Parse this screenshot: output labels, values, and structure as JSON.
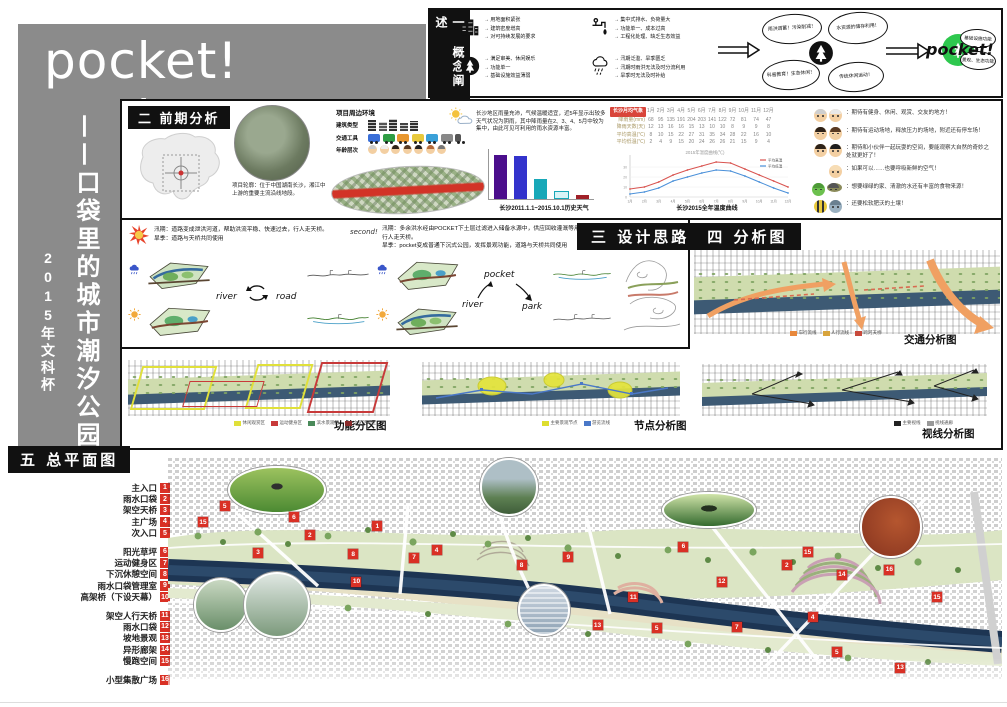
{
  "poster": {
    "title": "pocket! pocket!",
    "vertical_title": "——口袋里的城市潮汐公园",
    "vertical_sub": "2015年文科杯"
  },
  "concept": {
    "banner": "一 概念阐述",
    "groups": [
      {
        "icon": "city-buildings-icon",
        "bullets": [
          "用地面积紧张",
          "建筑密度增高",
          "对可持续发展的要求"
        ]
      },
      {
        "icon": "faucet-icon",
        "bullets": [
          "集中式排水、负荷量大",
          "功能单一、成本过高",
          "工程化处理、缺乏生态效益"
        ]
      },
      {
        "icon": "park-tree-icon",
        "bullets": [
          "满足审美、休闲娱乐",
          "功能单一",
          "基础设施效益薄弱"
        ]
      },
      {
        "icon": "rain-cloud-icon",
        "bullets": [
          "汛期泛滥、旱季匮乏",
          "汛期时雨洪无法及时分流利用",
          "旱季时无法及时补给"
        ]
      }
    ],
    "hub_bubbles": [
      "雨洪调蓄！污染削减！",
      "水资源的储存利用！",
      "科普教育！生态休闲！",
      "传统休闲运动！"
    ],
    "logo": "pocket!",
    "outcome_bubbles": [
      "基础设施功能",
      "景观、生态功能"
    ]
  },
  "analysis": {
    "banner": "二 前期分析",
    "location_text": "项目轮廓：位于中国湖南长沙，湘江中上游的重要主流沿线地段。",
    "env_title": "项目周边环境",
    "env_rows": [
      {
        "label": "建筑类型",
        "type": "building",
        "count": 5
      },
      {
        "label": "交通工具",
        "type": "vehicle",
        "count": 7
      },
      {
        "label": "年龄层次",
        "type": "face",
        "count": 7
      }
    ],
    "climate_text": "长沙地区雨量充沛，气候温暖适宜，近5年显示出较多天气状况为阴雨，其中降雨量在2、3、4、5月中较为集中，由此可见可利用的雨水资源丰富。",
    "voices": [
      {
        "who": [
          "elder-woman",
          "elder-man"
        ],
        "text": "期待有健身、休闲、观赏、交友的地方！"
      },
      {
        "who": [
          "man",
          "woman"
        ],
        "text": "期待有运动场地，释放压力的场地，附近还有停车场！"
      },
      {
        "who": [
          "man",
          "girl"
        ],
        "text": "期待和小伙伴一起玩耍的空间，要能观察大自然的奇妙之处就更好了！"
      },
      {
        "who": [
          "baby"
        ],
        "text": "如果可以……也要呼吸新鲜的空气！"
      },
      {
        "who": [
          "frog",
          "cricket"
        ],
        "text": "想要绿绿的家、清澈的水还有丰富的食物来源！"
      },
      {
        "who": [
          "bee",
          "bird"
        ],
        "text": "还要松软肥沃的土壤！"
      }
    ]
  },
  "chart_data": [
    {
      "type": "bar",
      "title": "长沙2011.1.1~2015.10.1历史天气",
      "categories": [
        "雨",
        "阴",
        "多云",
        "晴",
        "其他"
      ],
      "values": [
        620,
        600,
        280,
        90,
        60
      ],
      "colors": [
        "#4b0e8c",
        "#3333cc",
        "#18a8b8",
        "#18a8b8",
        "#a02028"
      ],
      "outline": [
        false,
        false,
        false,
        true,
        false
      ],
      "ylim": [
        0,
        700
      ],
      "ylabel": "天数"
    },
    {
      "type": "line",
      "title": "长沙2015全年温度曲线",
      "inner_title": "2015年温度曲线(℃)",
      "x": [
        "1月",
        "2月",
        "3月",
        "4月",
        "5月",
        "6月",
        "7月",
        "8月",
        "9月",
        "10月",
        "11月",
        "12月"
      ],
      "series": [
        {
          "name": "平均高温",
          "color": "#d9534f",
          "values": [
            8,
            10,
            15,
            22,
            27,
            31,
            35,
            34,
            28,
            22,
            16,
            10
          ]
        },
        {
          "name": "平均低温",
          "color": "#4a90d9",
          "values": [
            3,
            5,
            9,
            16,
            20,
            24,
            27,
            26,
            21,
            15,
            9,
            4
          ]
        }
      ],
      "ylim": [
        0,
        40
      ],
      "legend_position": "right"
    },
    {
      "type": "table",
      "title": "长沙月均气象",
      "columns": [
        "1月",
        "2月",
        "3月",
        "4月",
        "5月",
        "6月",
        "7月",
        "8月",
        "9月",
        "10月",
        "11月",
        "12月"
      ],
      "rows": [
        {
          "label": "降雨量(mm)",
          "values": [
            68,
            95,
            135,
            191,
            204,
            203,
            141,
            122,
            72,
            81,
            74,
            47
          ]
        },
        {
          "label": "降雨天数(天)",
          "values": [
            12,
            13,
            16,
            16,
            15,
            13,
            10,
            10,
            8,
            9,
            9,
            8
          ]
        },
        {
          "label": "平均高温(℃)",
          "values": [
            8,
            10,
            15,
            22,
            27,
            31,
            35,
            34,
            28,
            22,
            16,
            10
          ]
        },
        {
          "label": "平均低温(℃)",
          "values": [
            2,
            4,
            9,
            15,
            20,
            24,
            26,
            26,
            21,
            15,
            9,
            4
          ]
        }
      ]
    }
  ],
  "design": {
    "banner": "三 设计思路　四 分析图",
    "schemes": [
      {
        "tag": "",
        "text": "汛期：道路变成泄洪河道，帮助洪流平稳、快速过去，行人走天桥。\n旱季：道路与天桥共同使用"
      },
      {
        "tag": "second!",
        "text": "汛期：多余洪水经由POCKET下土层过滤进入储备水源中，供应回收灌溉等用途，行人走天桥。\n旱季：pocket变成普通下沉式公园，发挥景观功能，道路与天桥共同使用"
      },
      {
        "tag": "third!",
        "text": "综合考虑与形式"
      }
    ],
    "cycle": {
      "left": "river",
      "right": "road"
    },
    "flow": {
      "top": "pocket",
      "left": "river",
      "right": "park"
    }
  },
  "diagrams": {
    "items": [
      {
        "caption": "交通分析图",
        "legend": [
          {
            "label": "车行流线",
            "color": "#e8883c"
          },
          {
            "label": "人行流线",
            "color": "#d8a43c"
          },
          {
            "label": "跨河天桥",
            "color": "#c84a3c"
          }
        ]
      },
      {
        "caption": "功能分区图",
        "legend": [
          {
            "label": "休闲观赏区",
            "color": "#e0e03a"
          },
          {
            "label": "运动健身区",
            "color": "#c83a3a"
          },
          {
            "label": "滨水景观区",
            "color": "#4a8a5a"
          },
          {
            "label": "文化活动区",
            "color": "#8a2a2a"
          }
        ]
      },
      {
        "caption": "节点分析图",
        "legend": [
          {
            "label": "主要景观节点",
            "color": "#dede2e"
          },
          {
            "label": "游览流线",
            "color": "#4a78c8"
          }
        ]
      },
      {
        "caption": "视线分析图",
        "legend": [
          {
            "label": "主要视线",
            "color": "#222222"
          },
          {
            "label": "视线通廊",
            "color": "#999999"
          }
        ]
      }
    ]
  },
  "masterplan": {
    "banner": "五 总平面图",
    "legend_groups": [
      [
        {
          "n": 1,
          "label": "主入口"
        },
        {
          "n": 2,
          "label": "雨水口袋"
        },
        {
          "n": 3,
          "label": "架空天桥"
        },
        {
          "n": 4,
          "label": "主广场"
        },
        {
          "n": 5,
          "label": "次入口"
        }
      ],
      [
        {
          "n": 6,
          "label": "阳光草坪"
        },
        {
          "n": 7,
          "label": "运动健身区"
        },
        {
          "n": 8,
          "label": "下沉休憩空间"
        },
        {
          "n": 9,
          "label": "雨水口袋管理室"
        },
        {
          "n": 10,
          "label": "高架桥（下设天幕）"
        }
      ],
      [
        {
          "n": 11,
          "label": "架空人行天桥"
        },
        {
          "n": 12,
          "label": "雨水口袋"
        },
        {
          "n": 13,
          "label": "坡地景观"
        },
        {
          "n": 14,
          "label": "异形廊架"
        },
        {
          "n": 15,
          "label": "慢跑空间"
        }
      ],
      [
        {
          "n": 16,
          "label": "小型集散广场"
        }
      ]
    ],
    "markers": [
      {
        "n": "15",
        "x": 3.6,
        "y": 25.8
      },
      {
        "n": "5",
        "x": 6.2,
        "y": 19.5
      },
      {
        "n": "6",
        "x": 14.5,
        "y": 24
      },
      {
        "n": "2",
        "x": 16.4,
        "y": 31
      },
      {
        "n": "3",
        "x": 10.2,
        "y": 38
      },
      {
        "n": "1",
        "x": 24.5,
        "y": 27.4
      },
      {
        "n": "8",
        "x": 21.6,
        "y": 38.5
      },
      {
        "n": "7",
        "x": 28.9,
        "y": 40
      },
      {
        "n": "4",
        "x": 31.6,
        "y": 37
      },
      {
        "n": "8",
        "x": 41.8,
        "y": 42.9
      },
      {
        "n": "9",
        "x": 47.4,
        "y": 39.7
      },
      {
        "n": "10",
        "x": 22,
        "y": 49.6
      },
      {
        "n": "6",
        "x": 61.2,
        "y": 35.7
      },
      {
        "n": "15",
        "x": 76.1,
        "y": 37.7
      },
      {
        "n": "2",
        "x": 73.6,
        "y": 42.9
      },
      {
        "n": "14",
        "x": 80.2,
        "y": 46.8
      },
      {
        "n": "16",
        "x": 85.9,
        "y": 44.8
      },
      {
        "n": "12",
        "x": 65.8,
        "y": 49.6
      },
      {
        "n": "11",
        "x": 55.2,
        "y": 55.6
      },
      {
        "n": "15",
        "x": 91.6,
        "y": 55.6
      },
      {
        "n": "13",
        "x": 50.9,
        "y": 66.7
      },
      {
        "n": "5",
        "x": 58,
        "y": 67.9
      },
      {
        "n": "7",
        "x": 67.6,
        "y": 67.5
      },
      {
        "n": "4",
        "x": 76.7,
        "y": 63.5
      },
      {
        "n": "5",
        "x": 79.6,
        "y": 77.4
      },
      {
        "n": "13",
        "x": 87.2,
        "y": 83.7
      }
    ]
  }
}
